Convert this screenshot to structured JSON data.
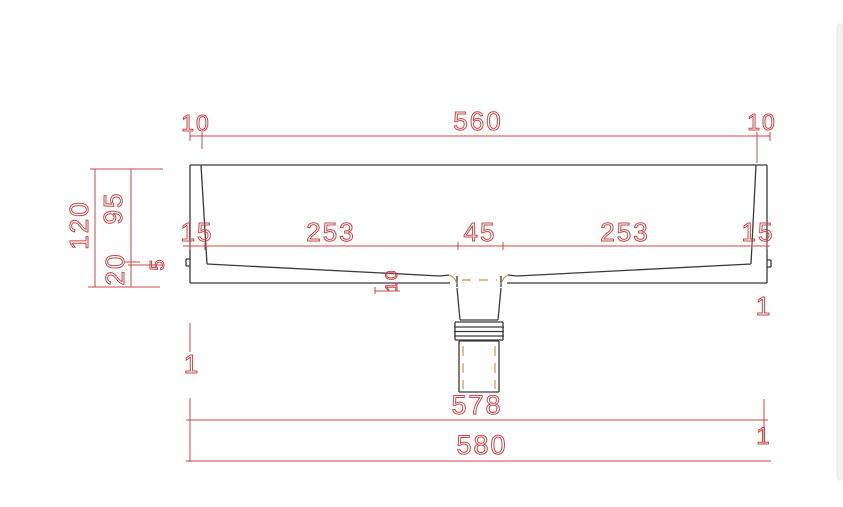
{
  "drawing": {
    "type": "cad-section-view",
    "subject": "rectangular-basin-cross-section-with-drain",
    "dims": {
      "top": {
        "left": "10",
        "center": "560",
        "right": "10"
      },
      "inner": {
        "left_wall": "15",
        "left_span": "253",
        "drain": "45",
        "right_span": "253",
        "right_wall": "15"
      },
      "side": {
        "total": "120",
        "depth": "95",
        "base": "20",
        "step": "5"
      },
      "drain_offset": "10",
      "bottom": {
        "inner": "578",
        "outer": "580"
      },
      "marks": {
        "left": "1",
        "right_upper": "1",
        "right_lower": "1"
      }
    },
    "colors": {
      "outline": "#3a3a3a",
      "dimension": "#c64848",
      "hidden": "#c3984f",
      "background": "#ffffff",
      "edge_strip": "#f2f2f2"
    }
  }
}
